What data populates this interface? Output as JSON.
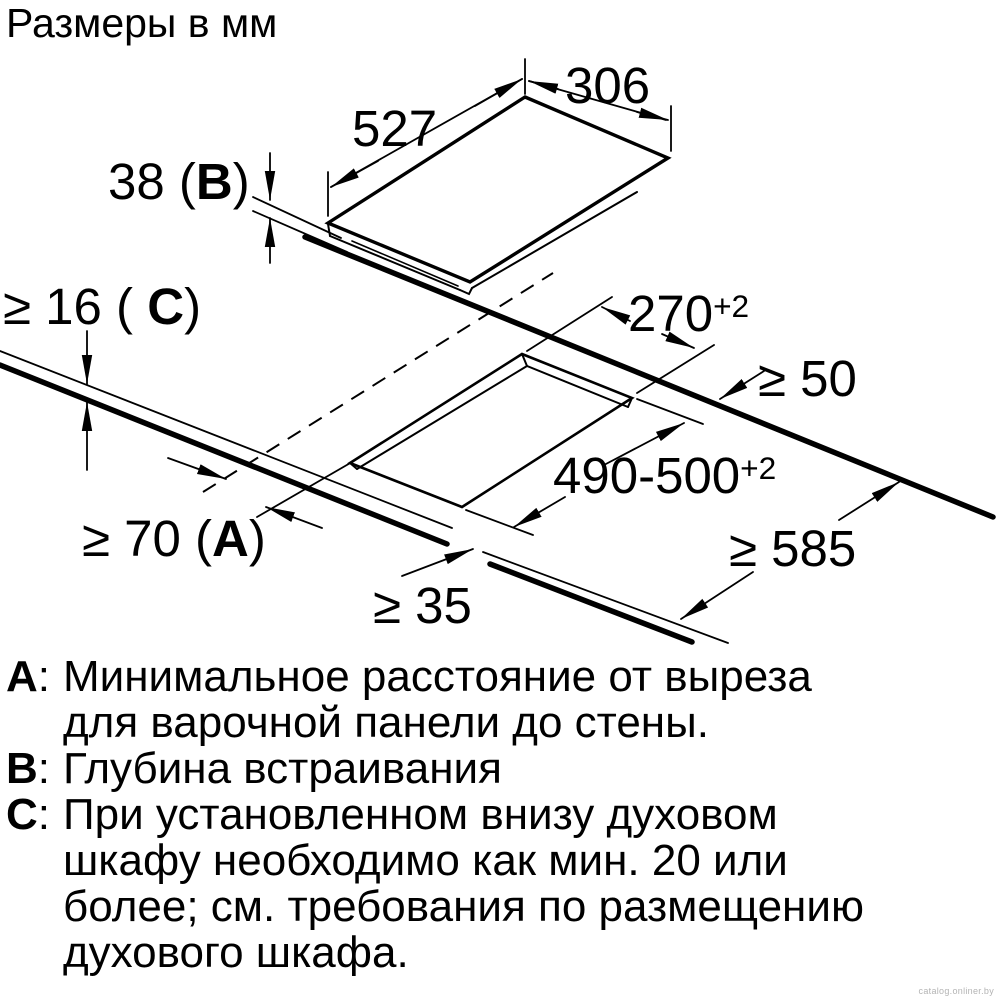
{
  "title": "Размеры в мм",
  "watermark": "catalog.onliner.by",
  "dimensions": {
    "top_width": "527",
    "top_depth": "306",
    "build_in_depth": {
      "prefix": "38 (",
      "letter": "B",
      "suffix": ")"
    },
    "worktop_thickness": {
      "prefix": "≥ 16 ( ",
      "letter": "C",
      "suffix": ")"
    },
    "cutout_depth": {
      "value": "270",
      "tolerance": "+2"
    },
    "cutout_width": {
      "value": "490-500",
      "tolerance": "+2"
    },
    "rear_clearance": "≥ 50",
    "worktop_depth": "≥ 585",
    "front_clearance": "≥ 35",
    "wall_clearance": {
      "prefix": "≥ 70 (",
      "letter": "A",
      "suffix": ")"
    }
  },
  "legend": {
    "items": [
      {
        "key": "A",
        "colon": ":",
        "lines": [
          "Минимальное расстояние от выреза",
          "для варочной панели до стены."
        ]
      },
      {
        "key": "B",
        "colon": ":",
        "lines": [
          "Глубина встраивания"
        ]
      },
      {
        "key": "C",
        "colon": ":",
        "lines": [
          "При установленном внизу духовом",
          "шкафу необходимо как мин. 20 или",
          "более; см. требования по размещению",
          "духового шкафа."
        ]
      }
    ]
  }
}
